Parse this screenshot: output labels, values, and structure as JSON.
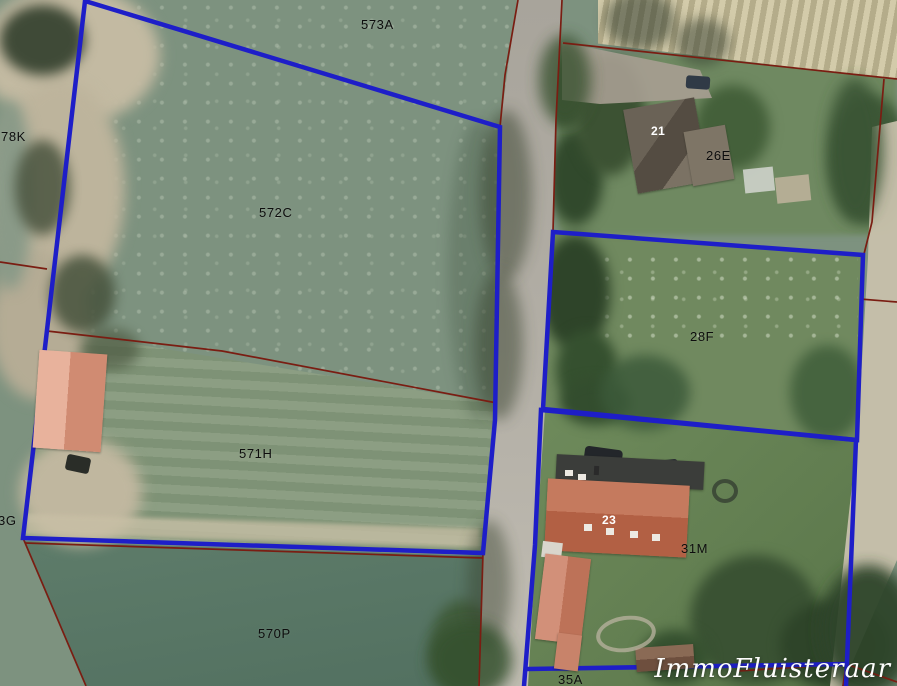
{
  "scene": {
    "description": "Aerial cadastral photograph with highlighted property parcels",
    "watermark": "ImmoFluisteraar"
  },
  "colors": {
    "parcel_highlight_blue": "#1e1ec8",
    "cadastral_red": "#7a1d12",
    "parcel_label_text": "#0d0d0d",
    "house_number_text": "#ffffff"
  },
  "parcel_labels": {
    "p573a": "573A",
    "p78k": "78K",
    "p572c": "572C",
    "p571h": "571H",
    "p3g": "3G",
    "p570p": "570P",
    "p26e": "26E",
    "p28f": "28F",
    "p31m": "31M",
    "p35a": "35A"
  },
  "house_numbers": {
    "h21": "21",
    "h23": "23"
  }
}
